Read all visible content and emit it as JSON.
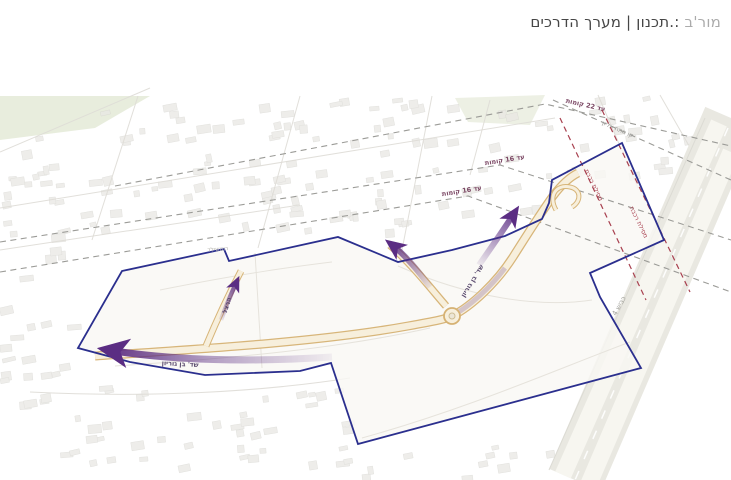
{
  "header": {
    "title_faded": "מור'ב",
    "title_main": ":.תכנון | מערך הדרכים"
  },
  "map": {
    "height_limits": [
      {
        "label": "עד 22 קומות"
      },
      {
        "label": "עד 16 קומות"
      },
      {
        "label": "עד 16 קומות"
      }
    ],
    "power_line_label": "קו מתח עליון",
    "railway_labels": [
      "מסילת רכבת",
      "מסילת רכבת"
    ],
    "roads": {
      "ben_gurion_south": "שד' בן גוריון",
      "ben_gurion_curve": "שד' בן גוריון",
      "herzl": "הרצל",
      "rothschild": "רוטשילד",
      "highway": "כביש 4"
    },
    "colors": {
      "boundary": "#2b2f8e",
      "arrow": "#5b2d83",
      "road_edge": "#d6b273",
      "height_line": "#9b9b97",
      "railway": "#a8404f"
    }
  }
}
